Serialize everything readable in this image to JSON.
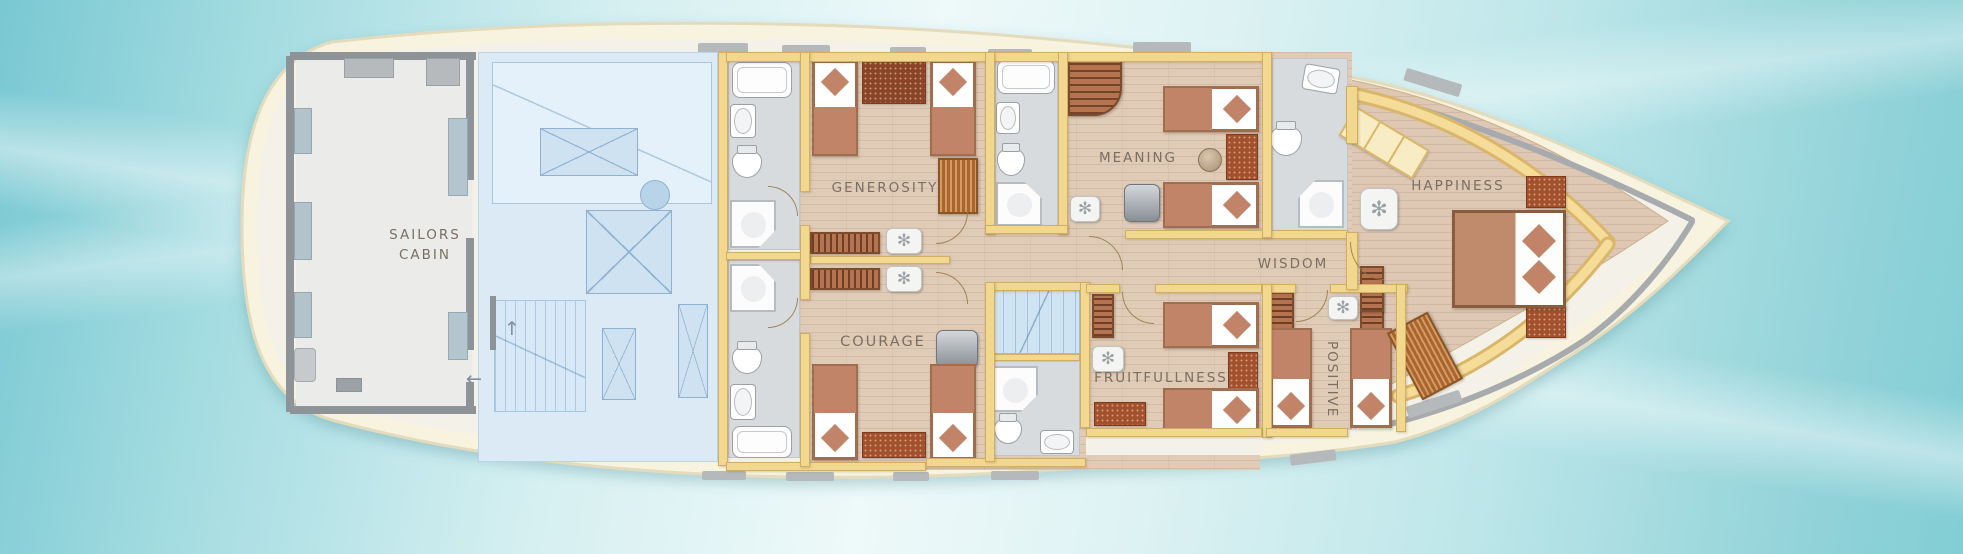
{
  "rooms": {
    "sailors_cabin": {
      "line1": "SAILORS",
      "line2": "CABIN"
    },
    "generosity": "GENEROSITY",
    "courage": "COURAGE",
    "meaning": "MEANING",
    "wisdom": "WISDOM",
    "fruitfullness": "FRUITFULLNESS",
    "positive": "POSITIVE",
    "happiness": "HAPPINESS"
  },
  "icons": {
    "fan": "✻",
    "arrow_up": "↑",
    "arrow_left": "←"
  },
  "colors": {
    "water_deep": "#79c8d2",
    "water_light": "#eef9f9",
    "hull": "#f7f3de",
    "deck": "#f4f2e8",
    "wall": "#f2d78e",
    "wood_floor": "#e0cbb7",
    "bath_floor": "#d8dbde",
    "engine_floor": "#dceaf6",
    "furniture_brown": "#b5734f",
    "bed_accent": "#c28468",
    "label_text": "#7b6f62"
  }
}
